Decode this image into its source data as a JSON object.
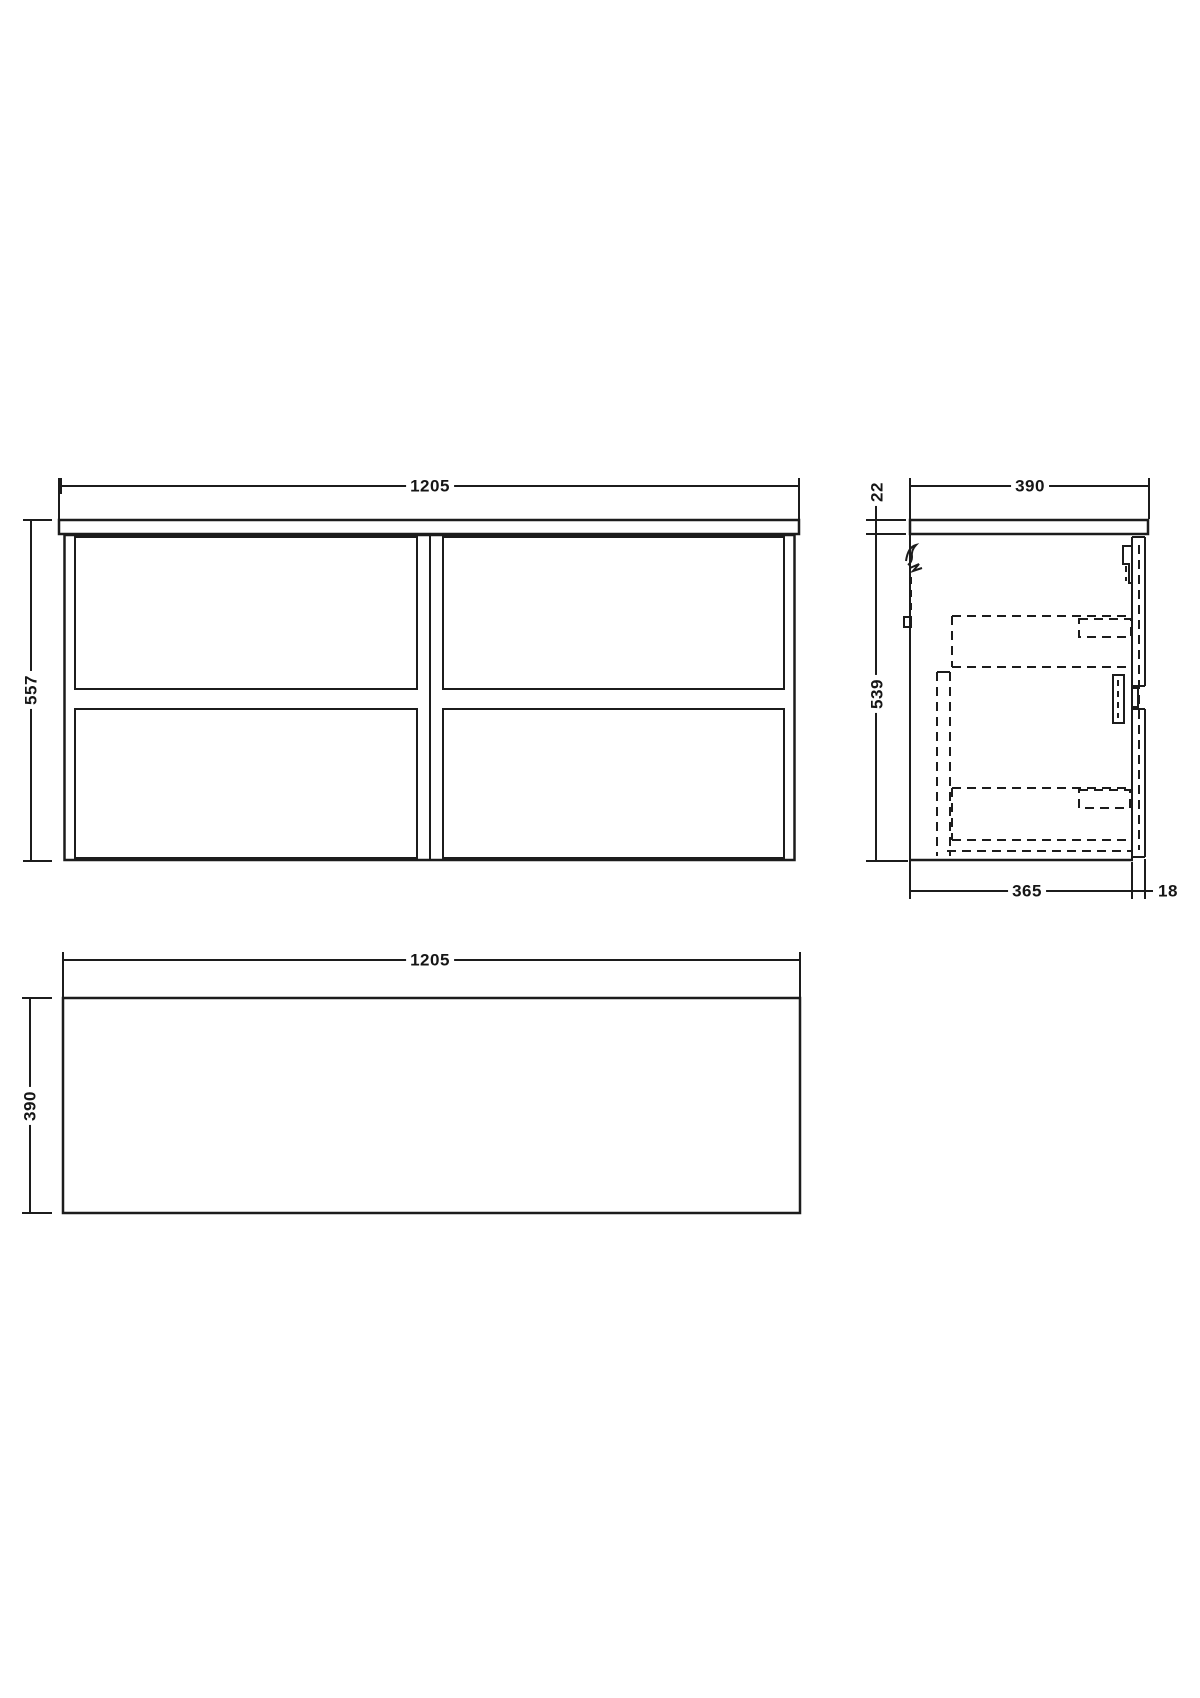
{
  "drawing": {
    "colors": {
      "line": "#1c1c1c",
      "background": "#ffffff"
    },
    "views": {
      "front": {
        "width": "1205",
        "height": "557"
      },
      "side": {
        "top_thickness": "22",
        "depth": "390",
        "body_height": "539",
        "body_depth": "365",
        "front_thickness": "18"
      },
      "plan": {
        "width": "1205",
        "depth": "390"
      }
    }
  }
}
